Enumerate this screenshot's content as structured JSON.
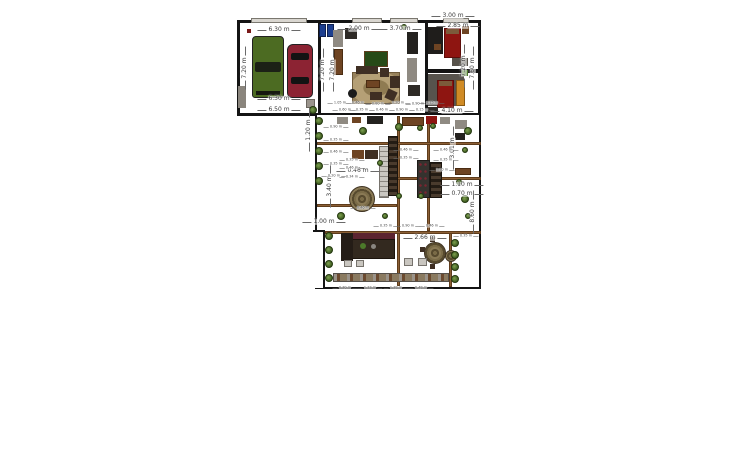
{
  "app": {
    "title": "floor-plan-canvas",
    "background": "#ffffff"
  },
  "colors": {
    "wall": "#141414",
    "wood_beam": "#8b5f35",
    "car_green": "#4c6b22",
    "car_red": "#8c2333",
    "bed_red": "#8e1511",
    "wardrobe_orange": "#d08b25",
    "rug_tan": "#b5a076",
    "plant_green": "#4c6b2a"
  },
  "plan": {
    "rooms": [
      {
        "n": "room-garage",
        "x": 237,
        "y": 20,
        "w": 84,
        "h": 96,
        "wall": 3
      },
      {
        "n": "room-living",
        "x": 318,
        "y": 20,
        "w": 110,
        "h": 96,
        "wall": 3
      },
      {
        "n": "room-bedroom-top-right",
        "x": 425,
        "y": 20,
        "w": 56,
        "h": 52,
        "wall": 3
      },
      {
        "n": "room-bedroom-right",
        "x": 425,
        "y": 70,
        "w": 56,
        "h": 46,
        "wall": 3
      },
      {
        "n": "room-courtyard",
        "x": 315,
        "y": 113,
        "w": 166,
        "h": 176,
        "wall": 2
      }
    ],
    "patches": [
      {
        "n": "wall-notch-patch",
        "x": 313,
        "y": 230,
        "w": 11,
        "h": 58
      }
    ],
    "wallsegs": [
      {
        "n": "wall-notch-vertical",
        "x": 323,
        "y": 230,
        "w": 2,
        "h": 59
      },
      {
        "n": "wall-notch-horizontal",
        "x": 313,
        "y": 230,
        "w": 12,
        "h": 2
      }
    ],
    "windows": [
      {
        "n": "window-garage-top",
        "x": 251,
        "y": 18,
        "w": 56,
        "h": 5
      },
      {
        "n": "window-living-top-1",
        "x": 352,
        "y": 18,
        "w": 30,
        "h": 5
      },
      {
        "n": "window-living-top-2",
        "x": 390,
        "y": 18,
        "w": 28,
        "h": 5
      },
      {
        "n": "window-bedroom-top",
        "x": 443,
        "y": 18,
        "w": 26,
        "h": 5
      }
    ],
    "beams": [
      {
        "n": "pergola-beam-v1",
        "x": 397,
        "y": 116,
        "w": 3,
        "h": 170
      },
      {
        "n": "pergola-beam-v2",
        "x": 427,
        "y": 116,
        "w": 3,
        "h": 115
      },
      {
        "n": "pergola-beam-v3",
        "x": 449,
        "y": 231,
        "w": 3,
        "h": 56
      },
      {
        "n": "pergola-beam-h1",
        "x": 317,
        "y": 142,
        "w": 164,
        "h": 3
      },
      {
        "n": "pergola-beam-h2",
        "x": 397,
        "y": 177,
        "w": 84,
        "h": 3
      },
      {
        "n": "pergola-beam-h3",
        "x": 317,
        "y": 204,
        "w": 80,
        "h": 3
      },
      {
        "n": "pergola-beam-h4",
        "x": 325,
        "y": 231,
        "w": 156,
        "h": 3
      }
    ],
    "furniture": [
      {
        "n": "pickup-truck",
        "k": "truck",
        "x": 252,
        "y": 36,
        "w": 32,
        "h": 62,
        "c": "#4c6b22"
      },
      {
        "n": "sedan-car",
        "k": "car",
        "x": 287,
        "y": 44,
        "w": 26,
        "h": 54,
        "c": "#8c2333"
      },
      {
        "n": "garage-cabinet",
        "k": "rect",
        "x": 238,
        "y": 86,
        "w": 8,
        "h": 22,
        "c": "#8a857d"
      },
      {
        "n": "smoke-detector",
        "k": "rect",
        "x": 247,
        "y": 29,
        "w": 4,
        "h": 4,
        "c": "#7a1a1a"
      },
      {
        "n": "blue-bin-1",
        "k": "rect",
        "x": 319,
        "y": 24,
        "w": 7,
        "h": 13,
        "c": "#1d3f8f",
        "b": "#0e2050"
      },
      {
        "n": "blue-bin-2",
        "k": "rect",
        "x": 327,
        "y": 24,
        "w": 7,
        "h": 13,
        "c": "#1d3f8f",
        "b": "#0e2050"
      },
      {
        "n": "hall-cabinet",
        "k": "rect",
        "x": 333,
        "y": 30,
        "w": 10,
        "h": 17,
        "c": "#8f8a82"
      },
      {
        "n": "hall-wardrobe",
        "k": "rect",
        "x": 334,
        "y": 49,
        "w": 9,
        "h": 26,
        "c": "#6e4423",
        "b": "#4a2c12"
      },
      {
        "n": "living-console",
        "k": "rect",
        "x": 345,
        "y": 28,
        "w": 12,
        "h": 11,
        "c": "#2e2a26"
      },
      {
        "n": "wall-picture",
        "k": "rect",
        "x": 364,
        "y": 51,
        "w": 24,
        "h": 16,
        "c": "#274a17",
        "b": "#5e3c1c"
      },
      {
        "n": "living-rug",
        "k": "rug",
        "x": 352,
        "y": 72,
        "w": 48,
        "h": 32
      },
      {
        "n": "sofa-top",
        "k": "rect",
        "x": 356,
        "y": 66,
        "w": 22,
        "h": 8,
        "c": "#3f2f23"
      },
      {
        "n": "sofa-corner",
        "k": "rect",
        "x": 380,
        "y": 68,
        "w": 9,
        "h": 9,
        "c": "#3f2f23"
      },
      {
        "n": "sofa-right",
        "k": "rect",
        "x": 390,
        "y": 76,
        "w": 10,
        "h": 12,
        "c": "#3f2f23"
      },
      {
        "n": "armchair-1",
        "k": "rect",
        "x": 386,
        "y": 90,
        "w": 10,
        "h": 10,
        "c": "#3f2f23",
        "r": 25
      },
      {
        "n": "armchair-2",
        "k": "rect",
        "x": 370,
        "y": 92,
        "w": 12,
        "h": 8,
        "c": "#3f2f23"
      },
      {
        "n": "beanbag",
        "k": "circle",
        "x": 348,
        "y": 89,
        "w": 9,
        "h": 9,
        "c": "#1b1b1b"
      },
      {
        "n": "coffee-table",
        "k": "rect",
        "x": 366,
        "y": 80,
        "w": 14,
        "h": 8,
        "c": "#6e4423",
        "b": "#4a2c12"
      },
      {
        "n": "media-unit-tall",
        "k": "rect",
        "x": 407,
        "y": 32,
        "w": 11,
        "h": 22,
        "c": "#24221f"
      },
      {
        "n": "shelf-gray",
        "k": "rect",
        "x": 407,
        "y": 58,
        "w": 10,
        "h": 24,
        "c": "#8f8a82"
      },
      {
        "n": "tv-console",
        "k": "rect",
        "x": 408,
        "y": 85,
        "w": 12,
        "h": 11,
        "c": "#2e2a26"
      },
      {
        "n": "piano-desk",
        "k": "rect",
        "x": 428,
        "y": 27,
        "w": 15,
        "h": 27,
        "c": "#1f1d1b"
      },
      {
        "n": "desk-chair",
        "k": "rect",
        "x": 434,
        "y": 44,
        "w": 7,
        "h": 6,
        "c": "#6e4423"
      },
      {
        "n": "bed-top",
        "k": "rect",
        "x": 444,
        "y": 28,
        "w": 17,
        "h": 30,
        "c": "#8e1511",
        "b": "#5c0d0a"
      },
      {
        "n": "bed-top-pillow",
        "k": "rect",
        "x": 446,
        "y": 29,
        "w": 13,
        "h": 5,
        "c": "#7c5a3a"
      },
      {
        "n": "nightstand-top",
        "k": "rect",
        "x": 462,
        "y": 26,
        "w": 7,
        "h": 8,
        "c": "#6e4423"
      },
      {
        "n": "bedroom-rug-small",
        "k": "rect",
        "x": 452,
        "y": 58,
        "w": 16,
        "h": 8,
        "c": "#57524a"
      },
      {
        "n": "bedroom2-rug",
        "k": "rect",
        "x": 428,
        "y": 74,
        "w": 36,
        "h": 32,
        "c": "#57534d"
      },
      {
        "n": "bed-lower",
        "k": "rect",
        "x": 437,
        "y": 80,
        "w": 17,
        "h": 28,
        "c": "#8e1511",
        "b": "#5c0d0a"
      },
      {
        "n": "bed-lower-pillow",
        "k": "rect",
        "x": 439,
        "y": 81,
        "w": 13,
        "h": 5,
        "c": "#7c5a3a"
      },
      {
        "n": "wardrobe-orange",
        "k": "rect",
        "x": 456,
        "y": 80,
        "w": 9,
        "h": 26,
        "c": "#d08b25",
        "b": "#8a5a12"
      },
      {
        "n": "green-box",
        "k": "rect",
        "x": 462,
        "y": 70,
        "w": 6,
        "h": 6,
        "c": "#4c7a2a"
      },
      {
        "n": "bedroom2-dresser",
        "k": "rect",
        "x": 428,
        "y": 107,
        "w": 10,
        "h": 6,
        "c": "#2e2a26"
      },
      {
        "n": "stairs",
        "k": "stairs",
        "x": 379,
        "y": 146,
        "w": 10,
        "h": 52
      },
      {
        "n": "stone-wall-1",
        "k": "stone",
        "x": 388,
        "y": 136,
        "w": 10,
        "h": 60
      },
      {
        "n": "stone-wall-2",
        "k": "stone",
        "x": 430,
        "y": 162,
        "w": 12,
        "h": 36
      },
      {
        "n": "wine-rack-panel",
        "k": "dotpanel",
        "x": 417,
        "y": 160,
        "w": 13,
        "h": 38
      },
      {
        "n": "round-rug",
        "k": "roundrug",
        "x": 349,
        "y": 186,
        "w": 26,
        "h": 26
      },
      {
        "n": "dining-round-rug",
        "k": "roundrug",
        "x": 424,
        "y": 242,
        "w": 22,
        "h": 22
      },
      {
        "n": "dining-table-small",
        "k": "roundrug",
        "x": 445,
        "y": 250,
        "w": 12,
        "h": 12
      },
      {
        "n": "dining-chair-1",
        "k": "rect",
        "x": 420,
        "y": 247,
        "w": 5,
        "h": 5,
        "c": "#3f2f23"
      },
      {
        "n": "dining-chair-2",
        "k": "rect",
        "x": 430,
        "y": 237,
        "w": 5,
        "h": 5,
        "c": "#3f2f23"
      },
      {
        "n": "dining-chair-3",
        "k": "rect",
        "x": 430,
        "y": 264,
        "w": 5,
        "h": 5,
        "c": "#3f2f23"
      },
      {
        "n": "kitchen-shelf-band",
        "k": "rect",
        "x": 341,
        "y": 233,
        "w": 54,
        "h": 6,
        "c": "#5c2430"
      },
      {
        "n": "kitchen-counter",
        "k": "rect",
        "x": 341,
        "y": 239,
        "w": 54,
        "h": 20,
        "c": "#33291f",
        "b": "#1c140d"
      },
      {
        "n": "kitchen-tall-unit",
        "k": "rect",
        "x": 341,
        "y": 233,
        "w": 12,
        "h": 28,
        "c": "#241c16"
      },
      {
        "n": "fruit-bowl",
        "k": "circle",
        "x": 360,
        "y": 243,
        "w": 6,
        "h": 6,
        "c": "#4c7a2a"
      },
      {
        "n": "kitchen-pot",
        "k": "circle",
        "x": 371,
        "y": 244,
        "w": 5,
        "h": 5,
        "c": "#8a8680"
      },
      {
        "n": "appliance-1",
        "k": "rect",
        "x": 344,
        "y": 260,
        "w": 8,
        "h": 7,
        "c": "#c9c6c0",
        "b": "#77736d"
      },
      {
        "n": "appliance-2",
        "k": "rect",
        "x": 356,
        "y": 260,
        "w": 8,
        "h": 7,
        "c": "#c9c6c0",
        "b": "#77736d"
      },
      {
        "n": "storage-box-1",
        "k": "rect",
        "x": 404,
        "y": 258,
        "w": 9,
        "h": 8,
        "c": "#c9c6c0",
        "b": "#77736d"
      },
      {
        "n": "storage-box-2",
        "k": "rect",
        "x": 418,
        "y": 258,
        "w": 9,
        "h": 8,
        "c": "#c9c6c0",
        "b": "#77736d"
      },
      {
        "n": "sideboard-1",
        "k": "rect",
        "x": 337,
        "y": 117,
        "w": 11,
        "h": 7,
        "c": "#8f8a82"
      },
      {
        "n": "sideboard-2",
        "k": "rect",
        "x": 352,
        "y": 117,
        "w": 9,
        "h": 6,
        "c": "#6e4423"
      },
      {
        "n": "console-dark",
        "k": "rect",
        "x": 367,
        "y": 116,
        "w": 16,
        "h": 8,
        "c": "#24221f"
      },
      {
        "n": "kitchen-run",
        "k": "rect",
        "x": 402,
        "y": 117,
        "w": 22,
        "h": 9,
        "c": "#6e4423",
        "b": "#4a2c12"
      },
      {
        "n": "red-cabinet",
        "k": "rect",
        "x": 426,
        "y": 116,
        "w": 11,
        "h": 8,
        "c": "#8e1511"
      },
      {
        "n": "gray-cabinet-2",
        "k": "rect",
        "x": 440,
        "y": 117,
        "w": 10,
        "h": 7,
        "c": "#8f8a82"
      },
      {
        "n": "side-table-1",
        "k": "rect",
        "x": 352,
        "y": 150,
        "w": 12,
        "h": 9,
        "c": "#6e4423"
      },
      {
        "n": "side-table-2",
        "k": "rect",
        "x": 365,
        "y": 150,
        "w": 13,
        "h": 9,
        "c": "#3f2f23"
      },
      {
        "n": "bench-right",
        "k": "rect",
        "x": 455,
        "y": 168,
        "w": 16,
        "h": 7,
        "c": "#6e4423",
        "b": "#4a2c12"
      },
      {
        "n": "cabinet-right-1",
        "k": "rect",
        "x": 455,
        "y": 120,
        "w": 12,
        "h": 9,
        "c": "#8f8a82"
      },
      {
        "n": "cabinet-right-2",
        "k": "rect",
        "x": 455,
        "y": 133,
        "w": 10,
        "h": 7,
        "c": "#24221f"
      },
      {
        "n": "corner-box",
        "k": "rect",
        "x": 306,
        "y": 99,
        "w": 9,
        "h": 9,
        "c": "#9a948c",
        "b": "#6b665f"
      },
      {
        "n": "terrace-railing",
        "k": "railing",
        "x": 333,
        "y": 273,
        "w": 116,
        "h": 9
      }
    ],
    "plants": [
      [
        319,
        121,
        4
      ],
      [
        319,
        136,
        4
      ],
      [
        319,
        151,
        4
      ],
      [
        319,
        166,
        4
      ],
      [
        319,
        181,
        4
      ],
      [
        329,
        236,
        4
      ],
      [
        329,
        250,
        4
      ],
      [
        329,
        264,
        4
      ],
      [
        329,
        278,
        4
      ],
      [
        468,
        131,
        4
      ],
      [
        465,
        150,
        3
      ],
      [
        459,
        182,
        3
      ],
      [
        465,
        199,
        4
      ],
      [
        468,
        216,
        3
      ],
      [
        455,
        243,
        4
      ],
      [
        455,
        255,
        4
      ],
      [
        455,
        267,
        4
      ],
      [
        455,
        279,
        4
      ],
      [
        363,
        131,
        4
      ],
      [
        399,
        127,
        4
      ],
      [
        420,
        128,
        3
      ],
      [
        433,
        126,
        3
      ],
      [
        380,
        163,
        3
      ],
      [
        399,
        196,
        3
      ],
      [
        421,
        196,
        3
      ],
      [
        341,
        216,
        4
      ],
      [
        385,
        216,
        3
      ],
      [
        313,
        110,
        4
      ],
      [
        404,
        27,
        3
      ]
    ],
    "labels": [
      {
        "text": "6.30 m",
        "x": 279,
        "y": 30,
        "v": false
      },
      {
        "text": "7.20 m",
        "x": 245,
        "y": 68,
        "v": true
      },
      {
        "text": "6.30 m",
        "x": 279,
        "y": 99,
        "v": false
      },
      {
        "text": "6.50 m",
        "x": 279,
        "y": 110,
        "v": false
      },
      {
        "text": "7.20 m",
        "x": 323,
        "y": 70,
        "v": true
      },
      {
        "text": "7.20 m",
        "x": 333,
        "y": 70,
        "v": true
      },
      {
        "text": "2.00 m",
        "x": 359,
        "y": 29,
        "v": false
      },
      {
        "text": "3.70 m",
        "x": 400,
        "y": 29,
        "v": false
      },
      {
        "text": "3.00 m",
        "x": 453,
        "y": 16,
        "v": false
      },
      {
        "text": "2.85 m",
        "x": 458,
        "y": 26,
        "v": false
      },
      {
        "text": "7.20 m",
        "x": 464,
        "y": 66,
        "v": true
      },
      {
        "text": "7.60 m",
        "x": 473,
        "y": 68,
        "v": true
      },
      {
        "text": "2.66 m",
        "x": 425,
        "y": 238,
        "v": false
      },
      {
        "text": "8.60 m",
        "x": 473,
        "y": 212,
        "v": true
      },
      {
        "text": "0.46 m",
        "x": 358,
        "y": 171,
        "v": false
      },
      {
        "text": "3.40 m",
        "x": 330,
        "y": 186,
        "v": true
      },
      {
        "text": "1.20 m",
        "x": 309,
        "y": 130,
        "v": true
      },
      {
        "text": "1.00 m",
        "x": 324,
        "y": 222,
        "v": false
      },
      {
        "text": "1.10 m",
        "x": 462,
        "y": 185,
        "v": false
      },
      {
        "text": "0.70 m",
        "x": 462,
        "y": 194,
        "v": false
      },
      {
        "text": "3.01 m",
        "x": 453,
        "y": 148,
        "v": true
      },
      {
        "text": "4.10 m",
        "x": 452,
        "y": 111,
        "v": false
      }
    ],
    "tiny_labels": [
      {
        "text": "1.05 m",
        "x": 340,
        "y": 103
      },
      {
        "text": "0.46 m",
        "x": 358,
        "y": 103
      },
      {
        "text": "0.80 m",
        "x": 378,
        "y": 104
      },
      {
        "text": "0.20 m",
        "x": 398,
        "y": 103
      },
      {
        "text": "0.90 m",
        "x": 418,
        "y": 104
      },
      {
        "text": "4.15 m",
        "x": 432,
        "y": 103
      },
      {
        "text": "0.60 m",
        "x": 345,
        "y": 110
      },
      {
        "text": "0.35 m",
        "x": 362,
        "y": 110
      },
      {
        "text": "0.46 m",
        "x": 382,
        "y": 110
      },
      {
        "text": "0.90 m",
        "x": 402,
        "y": 110
      },
      {
        "text": "0.15 m",
        "x": 422,
        "y": 110
      },
      {
        "text": "0.90 m",
        "x": 336,
        "y": 127
      },
      {
        "text": "0.35 m",
        "x": 336,
        "y": 140
      },
      {
        "text": "0.46 m",
        "x": 336,
        "y": 152
      },
      {
        "text": "0.35 m",
        "x": 336,
        "y": 164
      },
      {
        "text": "0.20 m",
        "x": 334,
        "y": 176
      },
      {
        "text": "0.35 m",
        "x": 352,
        "y": 160
      },
      {
        "text": "0.46 m",
        "x": 352,
        "y": 168
      },
      {
        "text": "0.34 m",
        "x": 352,
        "y": 177
      },
      {
        "text": "0.46 m",
        "x": 406,
        "y": 150
      },
      {
        "text": "0.35 m",
        "x": 406,
        "y": 158
      },
      {
        "text": "0.46 m",
        "x": 446,
        "y": 150
      },
      {
        "text": "0.35 m",
        "x": 446,
        "y": 160
      },
      {
        "text": "1.10 m",
        "x": 442,
        "y": 170
      },
      {
        "text": "0.35 m",
        "x": 466,
        "y": 236
      },
      {
        "text": "0.30 m",
        "x": 345,
        "y": 288
      },
      {
        "text": "1.33 m",
        "x": 370,
        "y": 288
      },
      {
        "text": "1.38 m",
        "x": 396,
        "y": 288
      },
      {
        "text": "0.48 m",
        "x": 421,
        "y": 288
      },
      {
        "text": "0.46 m",
        "x": 363,
        "y": 208
      },
      {
        "text": "0.35 m",
        "x": 386,
        "y": 226
      },
      {
        "text": "0.90 m",
        "x": 408,
        "y": 226
      },
      {
        "text": "0.46 m",
        "x": 432,
        "y": 226
      }
    ]
  }
}
